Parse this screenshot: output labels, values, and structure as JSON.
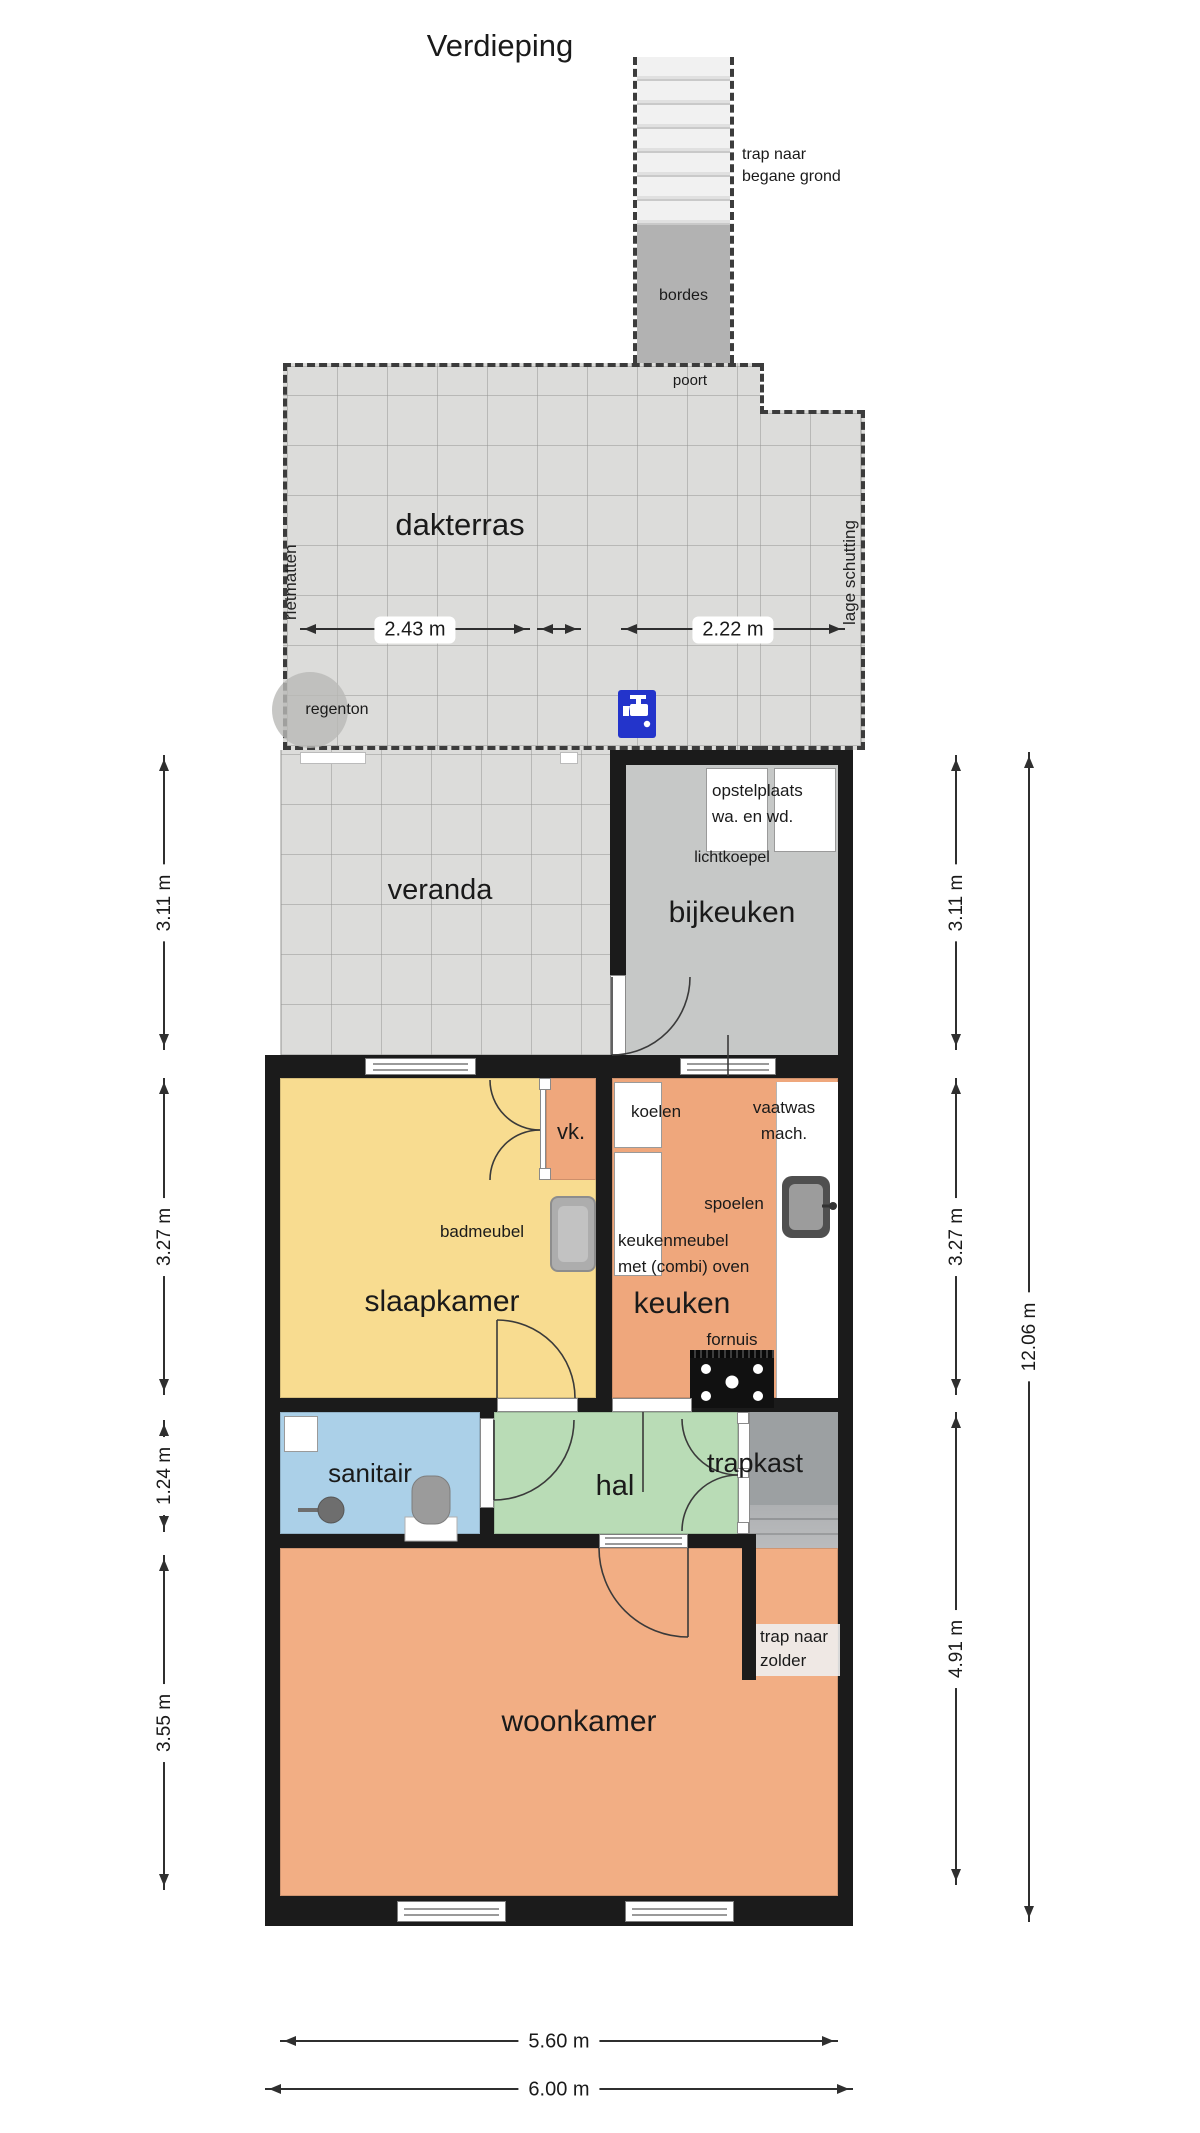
{
  "title": "Verdieping",
  "stairs_top": {
    "label_line1": "trap naar",
    "label_line2": "begane grond",
    "landing": "bordes",
    "gate": "poort"
  },
  "terrace": {
    "name": "dakterras",
    "left_fence": "rietmatten",
    "right_fence": "lage schutting",
    "rain_barrel": "regenton",
    "dim_left": "2.43 m",
    "dim_right": "2.22 m"
  },
  "rooms": {
    "veranda": "veranda",
    "bijkeuken": "bijkeuken",
    "slaapkamer": "slaapkamer",
    "vk": "vk.",
    "keuken": "keuken",
    "sanitair": "sanitair",
    "hal": "hal",
    "trapkast": "trapkast",
    "woonkamer": "woonkamer"
  },
  "bijkeuken_notes": {
    "opstel_line1": "opstelplaats",
    "opstel_line2": "wa. en wd.",
    "skylight": "lichtkoepel"
  },
  "keuken_notes": {
    "fridge": "koelen",
    "dishwasher_line1": "vaatwas",
    "dishwasher_line2": "mach.",
    "sink": "spoelen",
    "cabinet_line1": "keukenmeubel",
    "cabinet_line2": "met (combi) oven",
    "stove": "fornuis"
  },
  "slaapkamer_notes": {
    "bath_cabinet": "badmeubel"
  },
  "stairs_attic": {
    "label_line1": "trap naar",
    "label_line2": "zolder"
  },
  "dimensions": {
    "left": [
      "3.11 m",
      "3.27 m",
      "1.24 m",
      "3.55 m"
    ],
    "right": [
      "3.11 m",
      "3.27 m",
      "4.91 m"
    ],
    "right_total": "12.06 m",
    "bottom": [
      "5.60 m",
      "6.00 m"
    ]
  },
  "colors": {
    "wall": "#1b1b1b",
    "terrace_tile": "#dcdcda",
    "bijkeuken": "#c6c8c7",
    "landing": "#b2b2b2",
    "slaapkamer": "#f8dc90",
    "keuken": "#efa77c",
    "woonkamer": "#f2ae84",
    "sanitair": "#abd0e8",
    "hal": "#b9dcb6",
    "trapkast": "#9ca0a2",
    "tap_blue": "#2334cb"
  }
}
